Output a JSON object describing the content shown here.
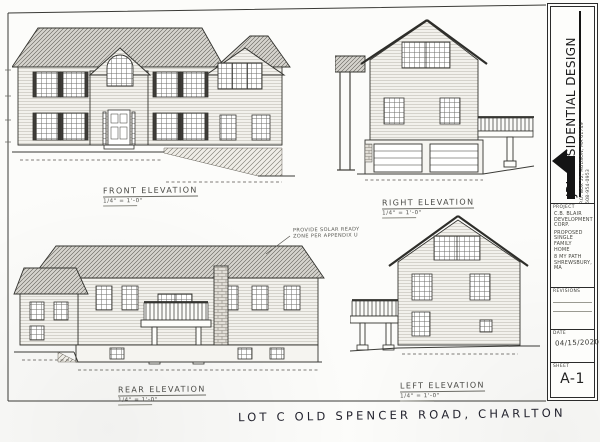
{
  "colors": {
    "paper": "#fcfcfa",
    "ink": "#2b2b2b",
    "pencil": "#4a4a46",
    "handwriting": "#23232e",
    "roof_gray": "#d6d4ce"
  },
  "sheet": {
    "handwritten_note": "LOT C OLD SPENCER ROAD, CHARLTON"
  },
  "elevations": {
    "front": {
      "label": "FRONT ELEVATION",
      "scale": "1/4\" = 1'-0\""
    },
    "right": {
      "label": "RIGHT ELEVATION",
      "scale": "1/4\" = 1'-0\""
    },
    "rear": {
      "label": "REAR ELEVATION",
      "scale": "1/4\" = 1'-0\"",
      "note": [
        "PROVIDE SOLAR READY",
        "ZONE PER APPENDIX U"
      ]
    },
    "left": {
      "label": "LEFT ELEVATION",
      "scale": "1/4\" = 1'-0\""
    }
  },
  "title_block": {
    "company": "JRL RESIDENTIAL DESIGN",
    "address": "P.O. BOX 52, HUDSON, MA 01749",
    "phone": "508-954-0953",
    "project_label": "PROJECT",
    "client_lines": [
      "C.B. BLAIR",
      "DEVELOPMENT",
      "CORP."
    ],
    "type_lines": [
      "PROPOSED",
      "SINGLE FAMILY",
      "HOME"
    ],
    "location_lines": [
      "8 MY PATH",
      "SHREWSBURY, MA"
    ],
    "revisions_label": "REVISIONS",
    "date_label": "DATE",
    "date_value": "04/15/2020",
    "sheet_label": "SHEET",
    "sheet_value": "A-1"
  },
  "icons": {
    "logo_arrow": "left-arrow"
  }
}
